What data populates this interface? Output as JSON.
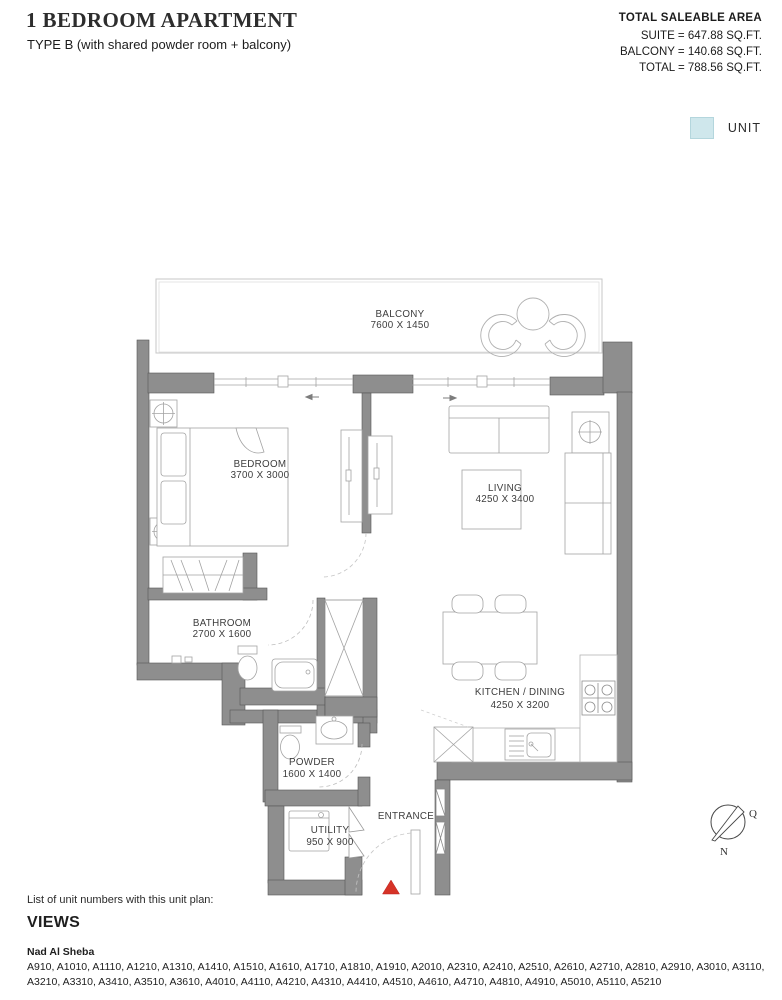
{
  "header": {
    "title": "1 BEDROOM APARTMENT",
    "subtitle": "TYPE B (with shared powder room + balcony)",
    "area_summary": {
      "heading": "TOTAL SALEABLE AREA",
      "lines": [
        "SUITE = 647.88 SQ.FT.",
        "BALCONY = 140.68 SQ.FT.",
        "TOTAL = 788.56 SQ.FT."
      ]
    },
    "legend": {
      "label": "UNIT",
      "swatch_color": "#cfe7ec"
    }
  },
  "plan": {
    "rooms": [
      {
        "name": "BALCONY",
        "dims": "7600 X 1450"
      },
      {
        "name": "BEDROOM",
        "dims": "3700 X 3000"
      },
      {
        "name": "LIVING",
        "dims": "4250 X 3400"
      },
      {
        "name": "BATHROOM",
        "dims": "2700 X 1600"
      },
      {
        "name": "KITCHEN / DINING",
        "dims": "4250 X 3200"
      },
      {
        "name": "POWDER",
        "dims": "1600 X 1400"
      },
      {
        "name": "UTILITY",
        "dims": "950 X 900"
      },
      {
        "name": "ENTRANCE",
        "dims": ""
      }
    ],
    "compass": {
      "q": "Q",
      "n": "N"
    },
    "colors": {
      "wall": "#8e8e8e",
      "entry_marker": "#d63327",
      "unit_swatch": "#cfe7ec"
    }
  },
  "footer": {
    "list_caption": "List of unit numbers with this unit plan:",
    "views_heading": "VIEWS",
    "views_area": "Nad Al Sheba",
    "unit_numbers_lines": [
      "A910, A1010, A1110, A1210, A1310, A1410, A1510, A1610, A1710, A1810, A1910, A2010, A2310, A2410, A2510, A2610, A2710, A2810, A2910, A3010, A3110,",
      "A3210, A3310, A3410, A3510, A3610, A4010, A4110, A4210, A4310, A4410, A4510, A4610, A4710, A4810, A4910, A5010, A5110, A5210"
    ]
  }
}
